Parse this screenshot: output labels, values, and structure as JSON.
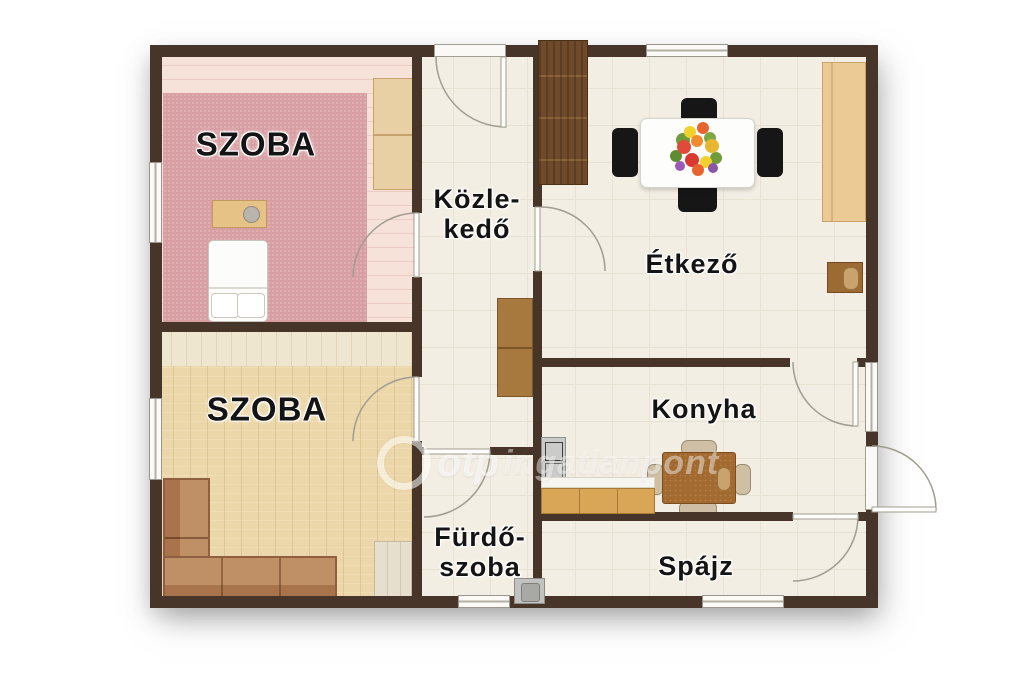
{
  "rooms": {
    "szoba_top": {
      "label": "SZOBA"
    },
    "szoba_bottom": {
      "label": "SZOBA"
    },
    "kozlekedo": {
      "line1": "Közle-",
      "line2": "kedő"
    },
    "etkezo": {
      "label": "Étkező"
    },
    "konyha": {
      "label": "Konyha"
    },
    "furdoszoba": {
      "line1": "Fürdő-",
      "line2": "szoba"
    },
    "spajz": {
      "label": "Spájz"
    }
  },
  "watermark": {
    "brand": "otp",
    "name": "ingatlanpont"
  },
  "colors": {
    "wall": "#463528",
    "tile_floor": "#f3eee3",
    "carpet": "#d89fa3",
    "pink_floor": "#f6e2d9",
    "wood_floor": "#ebd7a9",
    "dark_wood_furniture": "#6e4a2a",
    "dining_chair": "#161616"
  }
}
